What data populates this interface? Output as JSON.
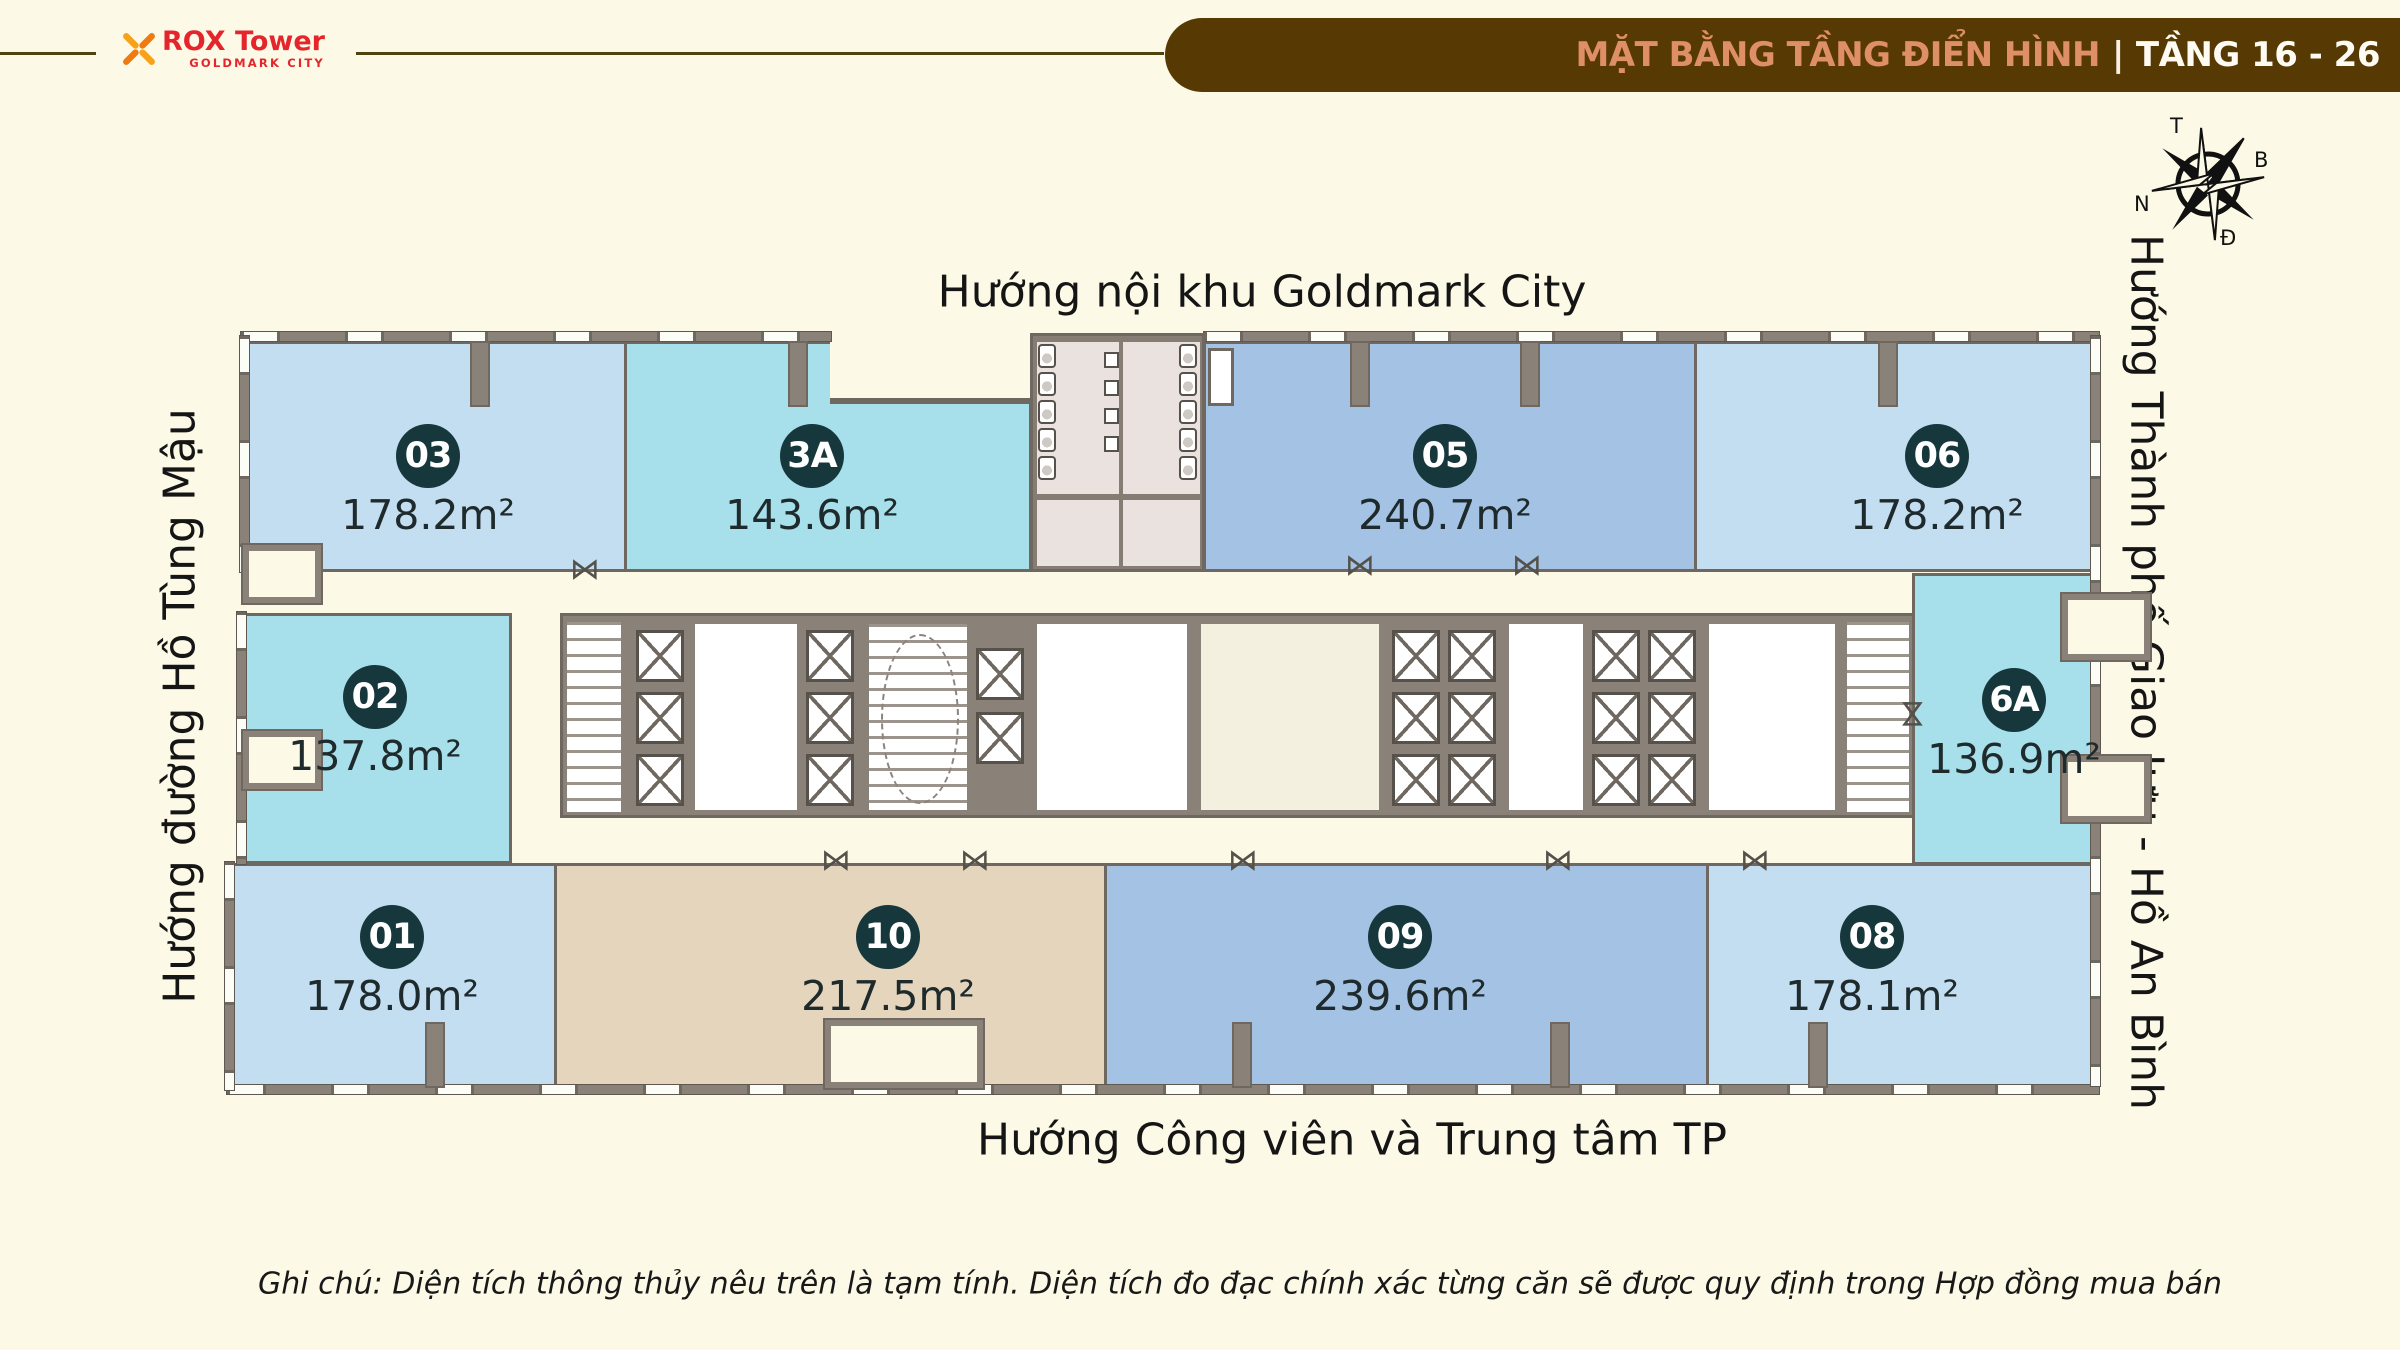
{
  "header": {
    "logo": {
      "brand_bold": "ROX",
      "brand_light": "Tower",
      "sub": "GOLDMARK CITY"
    },
    "banner": {
      "title": "MẶT BẰNG TẦNG ĐIỂN HÌNH",
      "separator": "|",
      "floors": "TẦNG 16 - 26"
    }
  },
  "compass": {
    "top": "T",
    "right": "B",
    "left": "N",
    "bottom": "Đ"
  },
  "directions": {
    "top": "Hướng nội khu Goldmark City",
    "left": "Hướng đường Hồ Tùng Mậu",
    "right": "Hướng Thành phố Giao lưu - Hồ An Bình",
    "bottom": "Hướng Công viên và Trung tâm TP"
  },
  "units": [
    {
      "id": "03",
      "area": "178.2m²",
      "color": "#C3DDF1"
    },
    {
      "id": "3A",
      "area": "143.6m²",
      "color": "#A7DFEA"
    },
    {
      "id": "05",
      "area": "240.7m²",
      "color": "#A4C3E4"
    },
    {
      "id": "06",
      "area": "178.2m²",
      "color": "#C3DDF1"
    },
    {
      "id": "02",
      "area": "137.8m²",
      "color": "#A7DFEA"
    },
    {
      "id": "6A",
      "area": "136.9m²",
      "color": "#A7DFEA"
    },
    {
      "id": "01",
      "area": "178.0m²",
      "color": "#C3DDF1"
    },
    {
      "id": "10",
      "area": "217.5m²",
      "color": "#E4D5BC"
    },
    {
      "id": "09",
      "area": "239.6m²",
      "color": "#A4C3E4"
    },
    {
      "id": "08",
      "area": "178.1m²",
      "color": "#C3DDF1"
    }
  ],
  "note": "Ghi chú: Diện tích thông thủy nêu trên là tạm tính. Diện tích đo đạc chính xác từng căn sẽ được quy định trong Hợp đồng mua bán",
  "icons": {
    "door_swing": "⋈"
  },
  "palette": {
    "background": "#FCF9E6",
    "banner_bg": "#573903",
    "banner_accent": "#DE8F66",
    "banner_floors": "#FDFBF2",
    "brand_red": "#E4262C",
    "brand_orange": "#F6A21C",
    "badge_bg": "#16373B",
    "wall_fill": "#8A8178",
    "wall_line": "#6F6860",
    "unit_light_blue": "#C3DDF1",
    "unit_cyan": "#A7DFEA",
    "unit_periwinkle": "#A4C3E4",
    "unit_tan": "#E4D5BC"
  }
}
